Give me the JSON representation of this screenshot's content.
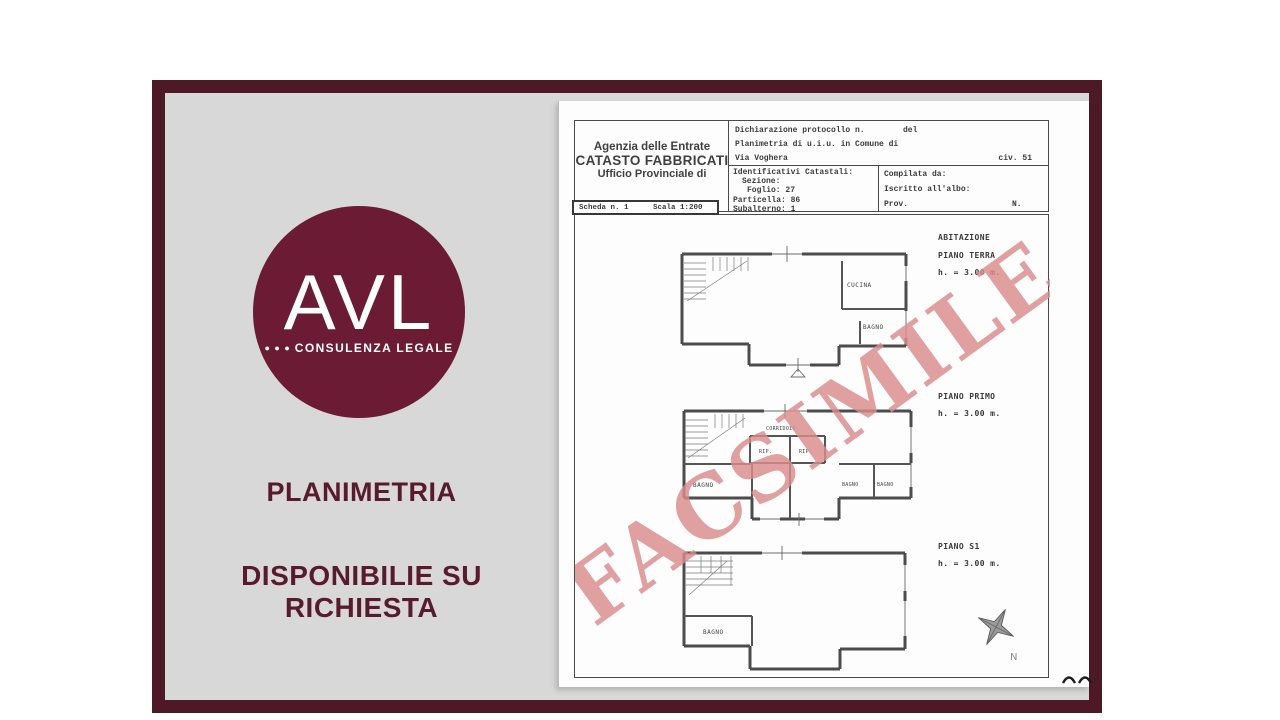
{
  "brand": {
    "logo": {
      "text": "AVL",
      "dots": "● ● ●",
      "subtitle": "CONSULENZA LEGALE"
    },
    "caption_line1": "PLANIMETRIA",
    "caption_line2": "DISPONIBILIE SU RICHIESTA",
    "colors": {
      "frame": "#4e1927",
      "panel_bg": "#d8d8d8",
      "logo_circle": "#6b1b33",
      "caption_text": "#581b2d",
      "watermark": "#db8c8c"
    }
  },
  "document": {
    "agency": {
      "line1": "Agenzia delle Entrate",
      "line2": "CATASTO FABBRICATI",
      "line3": "Ufficio Provinciale di"
    },
    "declaration": {
      "protocol": "Dichiarazione protocollo n.",
      "del": "del",
      "subject": "Planimetria di u.i.u. in Comune di",
      "street": "Via Voghera",
      "civ": "civ. 51"
    },
    "identifiers": {
      "title": "Identificativi Catastali:",
      "sezione": "Sezione:",
      "foglio": "Foglio: 27",
      "particella": "Particella: 86",
      "subalterno": "Subalterno: 1"
    },
    "compiler": {
      "compilata": "Compilata da:",
      "iscritto": "Iscritto all'albo:",
      "prov": "Prov.",
      "n": "N."
    },
    "scheda": {
      "number": "Scheda n. 1",
      "scale": "Scala 1:200"
    },
    "watermark": "FACSIMILE",
    "compass": "N",
    "floors": [
      {
        "name": "ABITAZIONE",
        "sub": "PIANO TERRA",
        "height": "h. = 3.00 m.",
        "rooms": {
          "cucina": "CUCINA",
          "bagno": "BAGNO"
        }
      },
      {
        "name": "PIANO PRIMO",
        "height": "h. = 3.00 m.",
        "rooms": {
          "corridoio": "CORRIDOIO",
          "rip1": "RIP.",
          "rip2": "RIP.",
          "bagno_left": "BAGNO",
          "bagno_mid": "BAGNO",
          "bagno_right": "BAGNO"
        }
      },
      {
        "name": "PIANO S1",
        "height": "h. = 3.00 m.",
        "rooms": {
          "bagno": "BAGNO"
        }
      }
    ]
  }
}
